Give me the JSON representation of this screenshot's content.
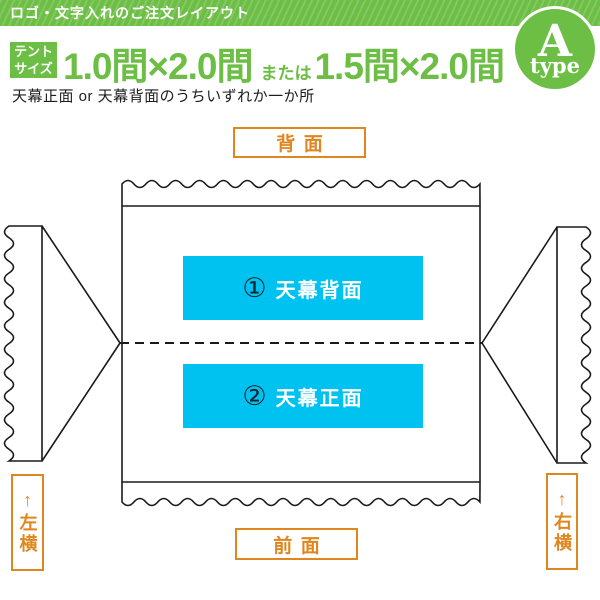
{
  "header": {
    "banner_title": "ロゴ・文字入れのご注文レイアウト",
    "size_badge_line1": "テント",
    "size_badge_line2": "サイズ",
    "size_option_1": "1.0間×2.0間",
    "size_connector": "または",
    "size_option_2": "1.5間×2.0間",
    "type_letter": "A",
    "type_word": "type",
    "note": "天幕正面 or 天幕背面のうちいずれか一か所"
  },
  "diagram": {
    "top_label": "背面",
    "bottom_label": "前面",
    "left_label": "↑左横",
    "right_label": "↑右横",
    "print_area_1": {
      "number": "①",
      "label": "天幕背面"
    },
    "print_area_2": {
      "number": "②",
      "label": "天幕正面"
    }
  },
  "colors": {
    "green": "#6cbe45",
    "orange": "#e0861f",
    "cyan": "#00c2f0",
    "line": "#1a1a1a"
  }
}
